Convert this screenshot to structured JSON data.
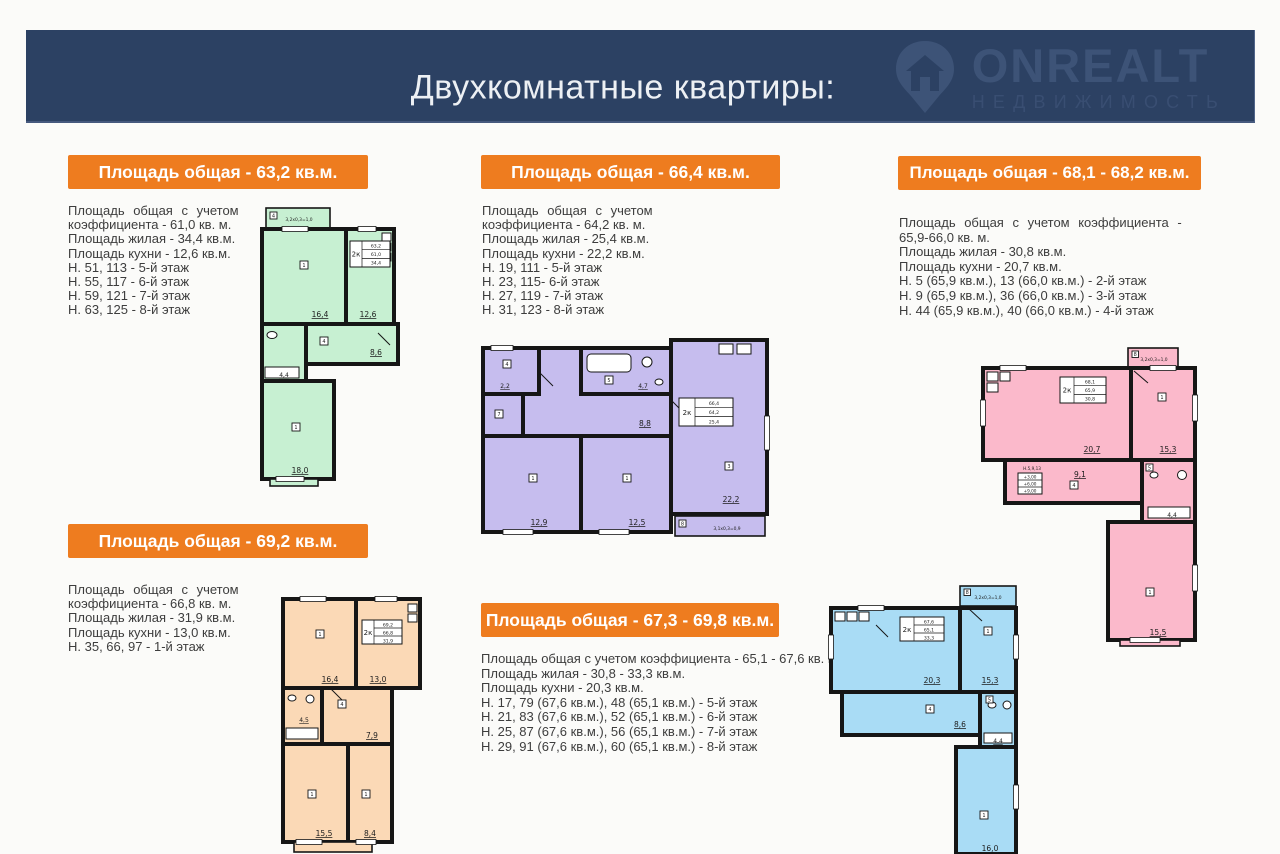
{
  "header": {
    "title": "Двухкомнатные квартиры:",
    "bg_color": "#2c4163",
    "logo": {
      "name": "ONREALT",
      "subtitle": "НЕДВИЖИМОСТЬ"
    }
  },
  "colors": {
    "badge": "#ee7c1f",
    "header_bg": "#2c4163",
    "text": "#3d3d3d"
  },
  "apartments": [
    {
      "badge": "Площадь общая - 63,2 кв.м.",
      "details": [
        "Площадь общая с учетом",
        "коэффициента - 61,0 кв. м.",
        "Площадь жилая - 34,4 кв.м.",
        "Площадь кухни - 12,6 кв.м.",
        "Н. 51, 113 - 5-й этаж",
        "Н. 55, 117 - 6-й этаж",
        "Н. 59, 121 - 7-й этаж",
        "Н. 63, 125 - 8-й этаж"
      ],
      "plan": {
        "fill": "#c7f0d2",
        "stamp": {
          "type": "2к",
          "rows": [
            "63,2",
            "61,0",
            "34,4"
          ]
        },
        "rooms": {
          "room1": "16,4",
          "kitchen": "12,6",
          "hall": "8,6",
          "bath": "4,4",
          "room2": "18,0"
        },
        "balcony_top": "3,2х0,3=1,0",
        "tags": {
          "balcony": "4",
          "room1": "1",
          "hall": "4",
          "room2": "1"
        }
      }
    },
    {
      "badge": "Площадь общая - 66,4 кв.м.",
      "details": [
        "Площадь общая с учетом",
        "коэффициента - 64,2 кв. м.",
        "Площадь жилая - 25,4 кв.м.",
        "Площадь кухни - 22,2 кв.м.",
        "Н. 19, 111 - 5-й этаж",
        "Н. 23, 115- 6-й этаж",
        "Н. 27, 119 - 7-й этаж",
        "Н. 31, 123 - 8-й этаж"
      ],
      "plan": {
        "fill": "#c6bdee",
        "stamp": {
          "type": "2к",
          "rows": [
            "66,4",
            "64,2",
            "25,4"
          ]
        },
        "rooms": {
          "entry": "2,2",
          "bath": "4,7",
          "hall": "8,8",
          "room1": "12,9",
          "room2": "12,5",
          "living": "22,2"
        },
        "balcony_bottom": "3,1х0,3=0,9",
        "tags": {
          "entry": "4",
          "storage": "7",
          "bath": "5",
          "room1": "1",
          "room2": "1",
          "living": "3",
          "balcony": "8"
        }
      }
    },
    {
      "badge": "Площадь общая - 68,1 - 68,2 кв.м.",
      "details": [
        "Площадь общая с учетом коэффициента -",
        "65,9-66,0 кв. м.",
        "Площадь жилая - 30,8 кв.м.",
        "Площадь кухни - 20,7 кв.м.",
        "Н. 5 (65,9 кв.м.), 13 (66,0 кв.м.) - 2-й этаж",
        "Н. 9 (65,9 кв.м.), 36 (66,0 кв.м.) - 3-й этаж",
        "Н. 44 (65,9 кв.м.), 40 (66,0 кв.м.) - 4-й этаж"
      ],
      "plan": {
        "fill": "#fbb9cb",
        "stamp": {
          "type": "2к",
          "rows": [
            "68,1",
            "65,9",
            "30,8"
          ]
        },
        "rooms": {
          "kitchen": "20,7",
          "room1": "15,3",
          "hall": "9,1",
          "bath": "4,4",
          "room2": "15,5"
        },
        "balcony_top": "3,2х0,3=1,0",
        "note": "Н.5,9,13",
        "elevations": [
          "+3,00",
          "+6,00",
          "+9,00"
        ],
        "tags": {
          "balcony": "8",
          "room1": "1",
          "hall": "4",
          "bath": "5",
          "room2": "1"
        }
      }
    },
    {
      "badge": "Площадь общая - 69,2 кв.м.",
      "details": [
        "Площадь общая с учетом",
        "коэффициента - 66,8 кв. м.",
        "Площадь жилая - 31,9 кв.м.",
        "Площадь кухни - 13,0 кв.м.",
        "Н. 35, 66, 97 - 1-й этаж"
      ],
      "plan": {
        "fill": "#fbd9b6",
        "stamp": {
          "type": "2к",
          "rows": [
            "69,2",
            "66,8",
            "31,9"
          ]
        },
        "rooms": {
          "room1": "16,4",
          "kitchen": "13,0",
          "bath": "4,5",
          "hall": "7,9",
          "room2": "15,5",
          "room3": "8,4"
        },
        "tags": {
          "room1": "1",
          "hall": "4",
          "room2": "1",
          "room3": "1"
        }
      }
    },
    {
      "badge": "Площадь общая - 67,3 - 69,8 кв.м.",
      "details": [
        "Площадь общая с учетом коэффициента - 65,1 - 67,6 кв. м.",
        "Площадь жилая - 30,8 - 33,3 кв.м.",
        "Площадь кухни - 20,3 кв.м.",
        "Н. 17, 79 (67,6 кв.м.), 48 (65,1 кв.м.) - 5-й этаж",
        "Н. 21, 83 (67,6 кв.м.), 52 (65,1 кв.м.) - 6-й этаж",
        "Н. 25, 87 (67,6 кв.м.), 56 (65,1 кв.м.) - 7-й этаж",
        "Н. 29, 91 (67,6 кв.м.), 60 (65,1 кв.м.) - 8-й этаж"
      ],
      "plan": {
        "fill": "#a9dcf5",
        "stamp": {
          "type": "2к",
          "rows": [
            "67,6",
            "65,1",
            "33,3"
          ]
        },
        "rooms": {
          "kitchen": "20,3",
          "room1": "15,3",
          "hall": "8,6",
          "bath": "4,4",
          "room2": "16,0"
        },
        "balcony_top": "3,2х0,3=1,0",
        "tags": {
          "balcony": "8",
          "room1": "1",
          "hall": "4",
          "bath": "5",
          "room2": "1"
        }
      }
    }
  ]
}
